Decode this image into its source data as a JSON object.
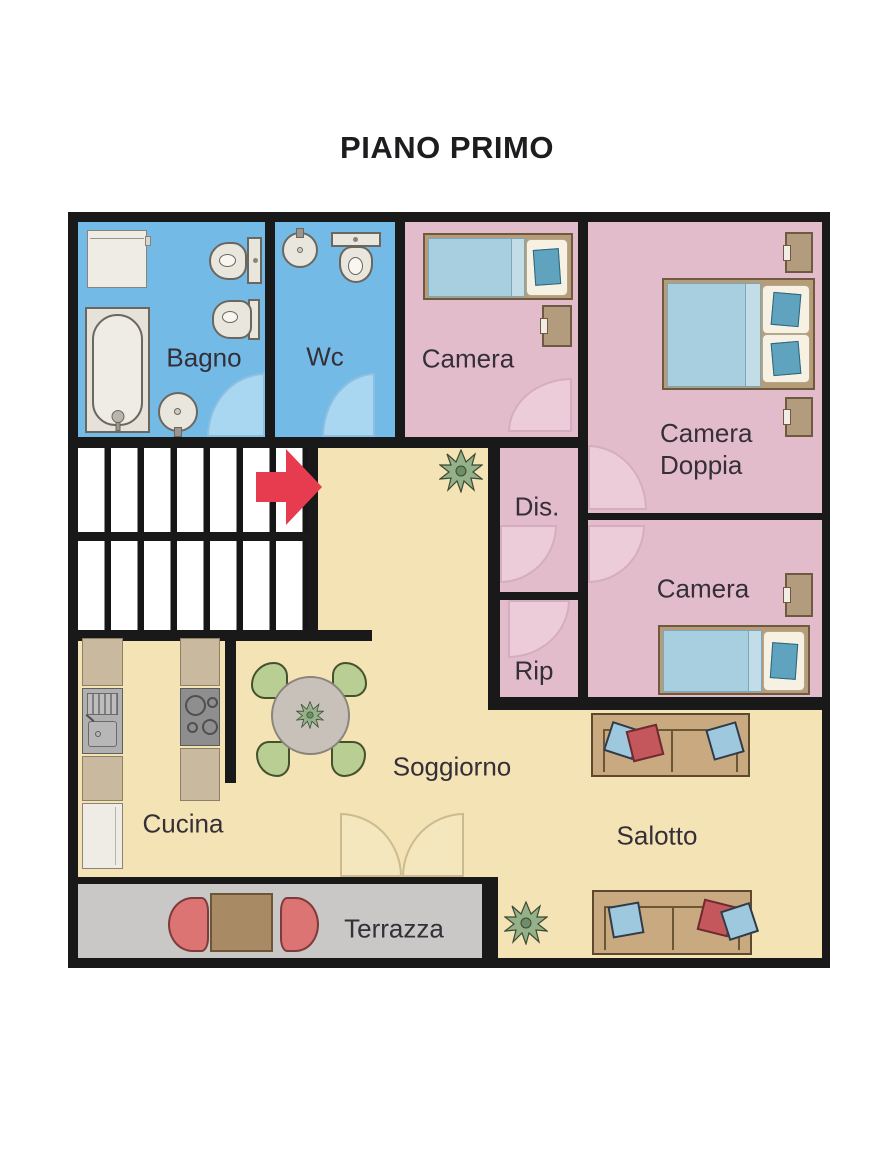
{
  "title": "PIANO PRIMO",
  "rooms": {
    "bagno": {
      "label": "Bagno",
      "color": "#74bae7"
    },
    "wc": {
      "label": "Wc",
      "color": "#74bae7"
    },
    "camera_top": {
      "label": "Camera",
      "color": "#e3bccb"
    },
    "camera_doppia": {
      "label_line1": "Camera",
      "label_line2": "Doppia",
      "color": "#e3bccb"
    },
    "camera_right": {
      "label": "Camera",
      "color": "#e3bccb"
    },
    "disimpegno": {
      "label": "Dis.",
      "color": "#e3bccb"
    },
    "ripostiglio": {
      "label": "Rip",
      "color": "#e3bccb"
    },
    "soggiorno": {
      "label": "Soggiorno",
      "color": "#f3e3b5"
    },
    "cucina": {
      "label": "Cucina",
      "color": "#f3e3b5"
    },
    "salotto": {
      "label": "Salotto",
      "color": "#f3e3b5"
    },
    "terrazza": {
      "label": "Terrazza",
      "color": "#c9c8c6"
    }
  },
  "colors": {
    "wall": "#191919",
    "stairs_arrow": "#e73c50",
    "door_arc_blue": "#a9d6f0",
    "door_arc_pink": "#ecccd8",
    "floor_cream": "#f3e3b5",
    "terrace_gray": "#c9c8c6"
  },
  "icons": {
    "stairs_arrow": "right-arrow"
  }
}
